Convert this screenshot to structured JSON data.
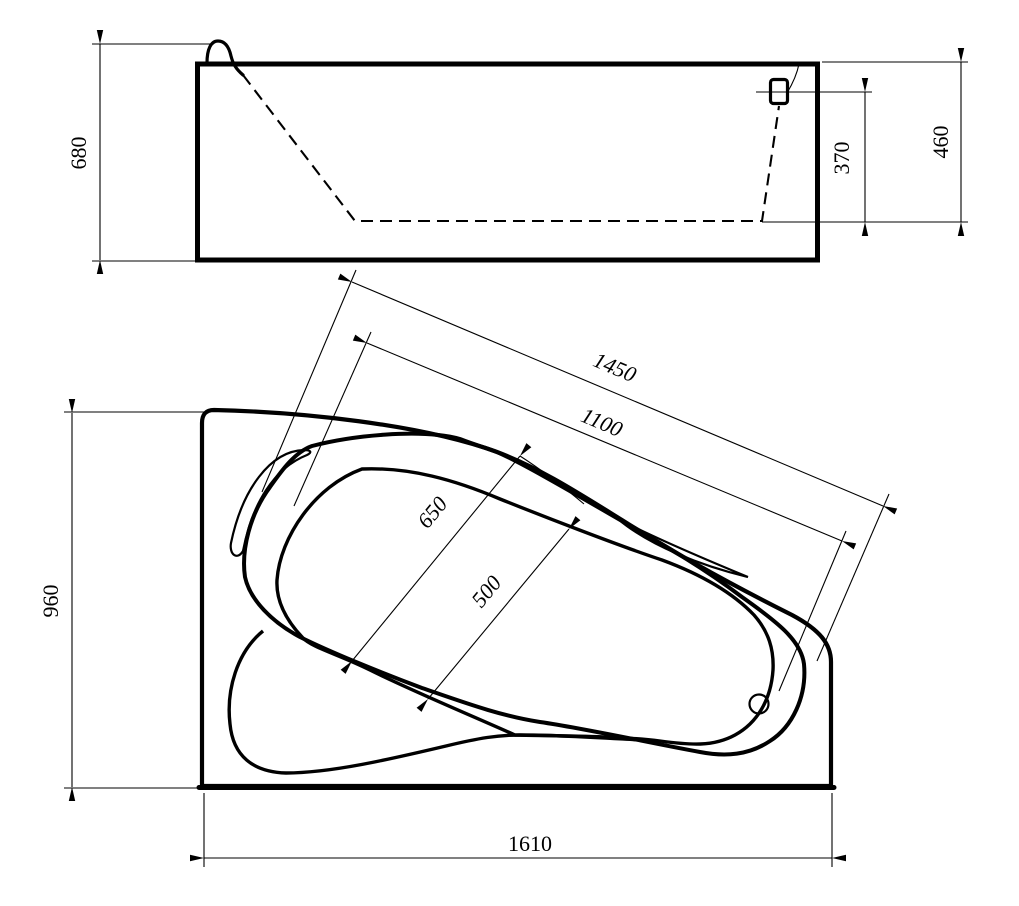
{
  "drawing": {
    "background": "#ffffff",
    "line_color": "#000000",
    "type": "bathtub technical drawing, two orthographic views",
    "dimensions": {
      "side_height": "680",
      "side_overflow_depth": "370",
      "side_rim_depth": "460",
      "plan_bowl_length_outer": "1450",
      "plan_bowl_length_inner": "1100",
      "plan_bowl_width_outer": "650",
      "plan_bowl_width_inner": "500",
      "plan_overall_width": "960",
      "plan_overall_length": "1610"
    }
  }
}
